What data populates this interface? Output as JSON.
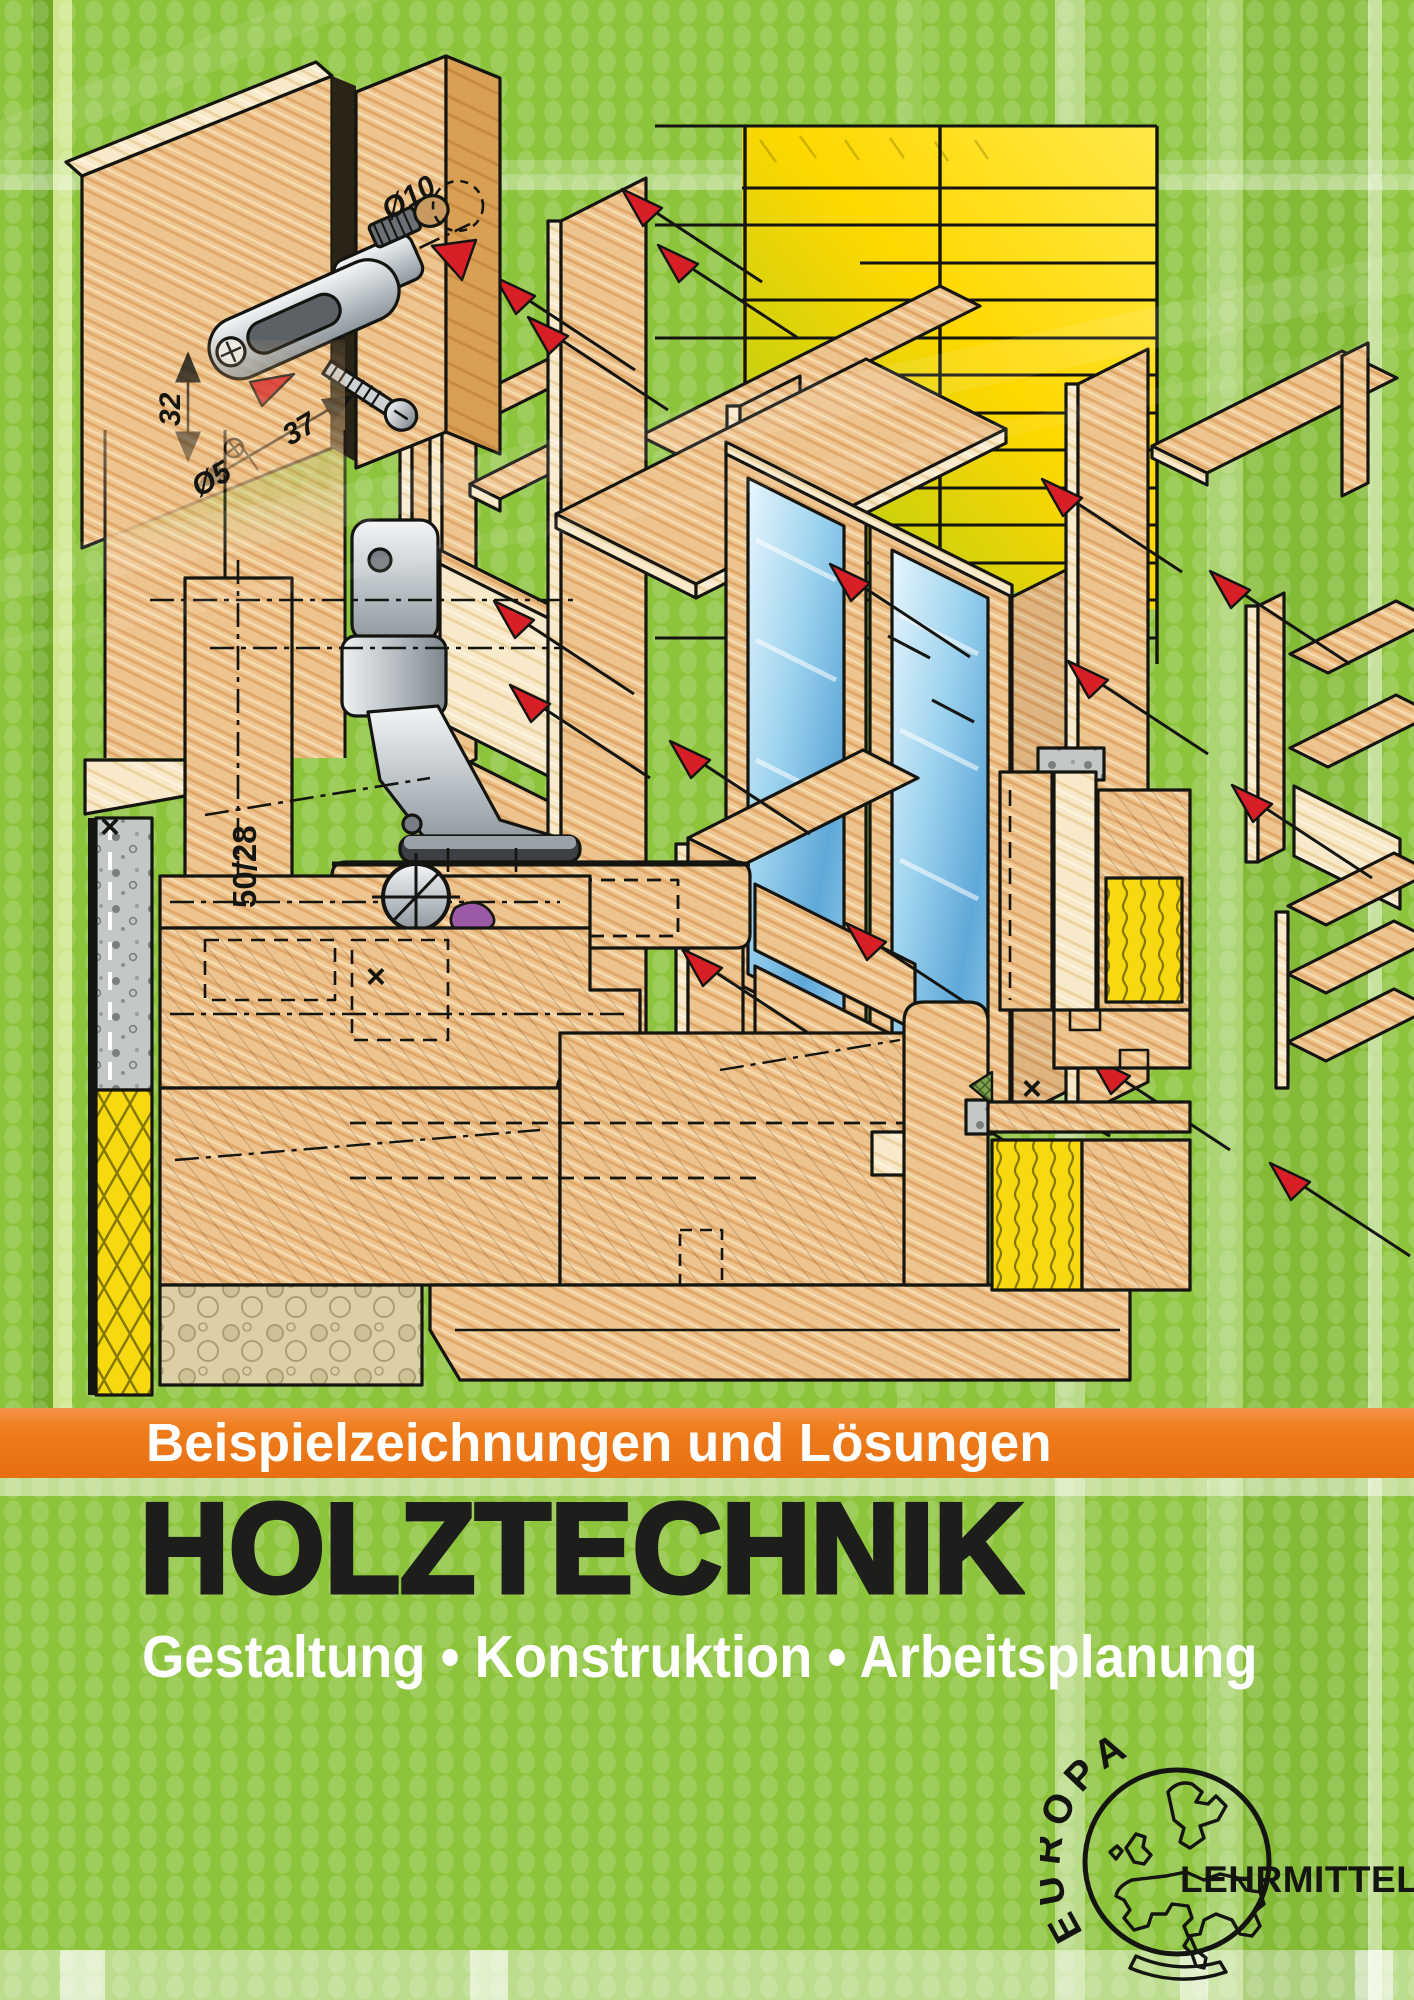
{
  "banner": {
    "text": "Beispielzeichnungen und Lösungen"
  },
  "title": "HOLZTECHNIK",
  "subtitle": "Gestaltung • Konstruktion • Arbeitsplanung",
  "publisher": {
    "arc_text": "EUROPA",
    "wordmark": "LEHRMITTEL"
  },
  "annotations": {
    "dia10": "Ø10",
    "dia5": "Ø5",
    "dim37": "37",
    "dim32": "32",
    "profile": "50/28",
    "cross": "×"
  },
  "colors": {
    "green": "#8cc43c",
    "green_stripe_dark": "#74ac28",
    "green_stripe_light": "#c0dc7f",
    "orange": "#ee7d1c",
    "title_black": "#1d1d1b",
    "white": "#ffffff",
    "wood": "#eec48e",
    "wood_light": "#f8ead0",
    "wood_dark": "#d9a055",
    "outline": "#141410",
    "arrow_red": "#d81e26",
    "insulation_yellow": "#f8d90f",
    "glass_blue": "#7fc0e8",
    "metal_gray": "#c3c9cd",
    "seal_purple": "#9a5aa5",
    "concrete_gray": "#c3c7c5"
  }
}
